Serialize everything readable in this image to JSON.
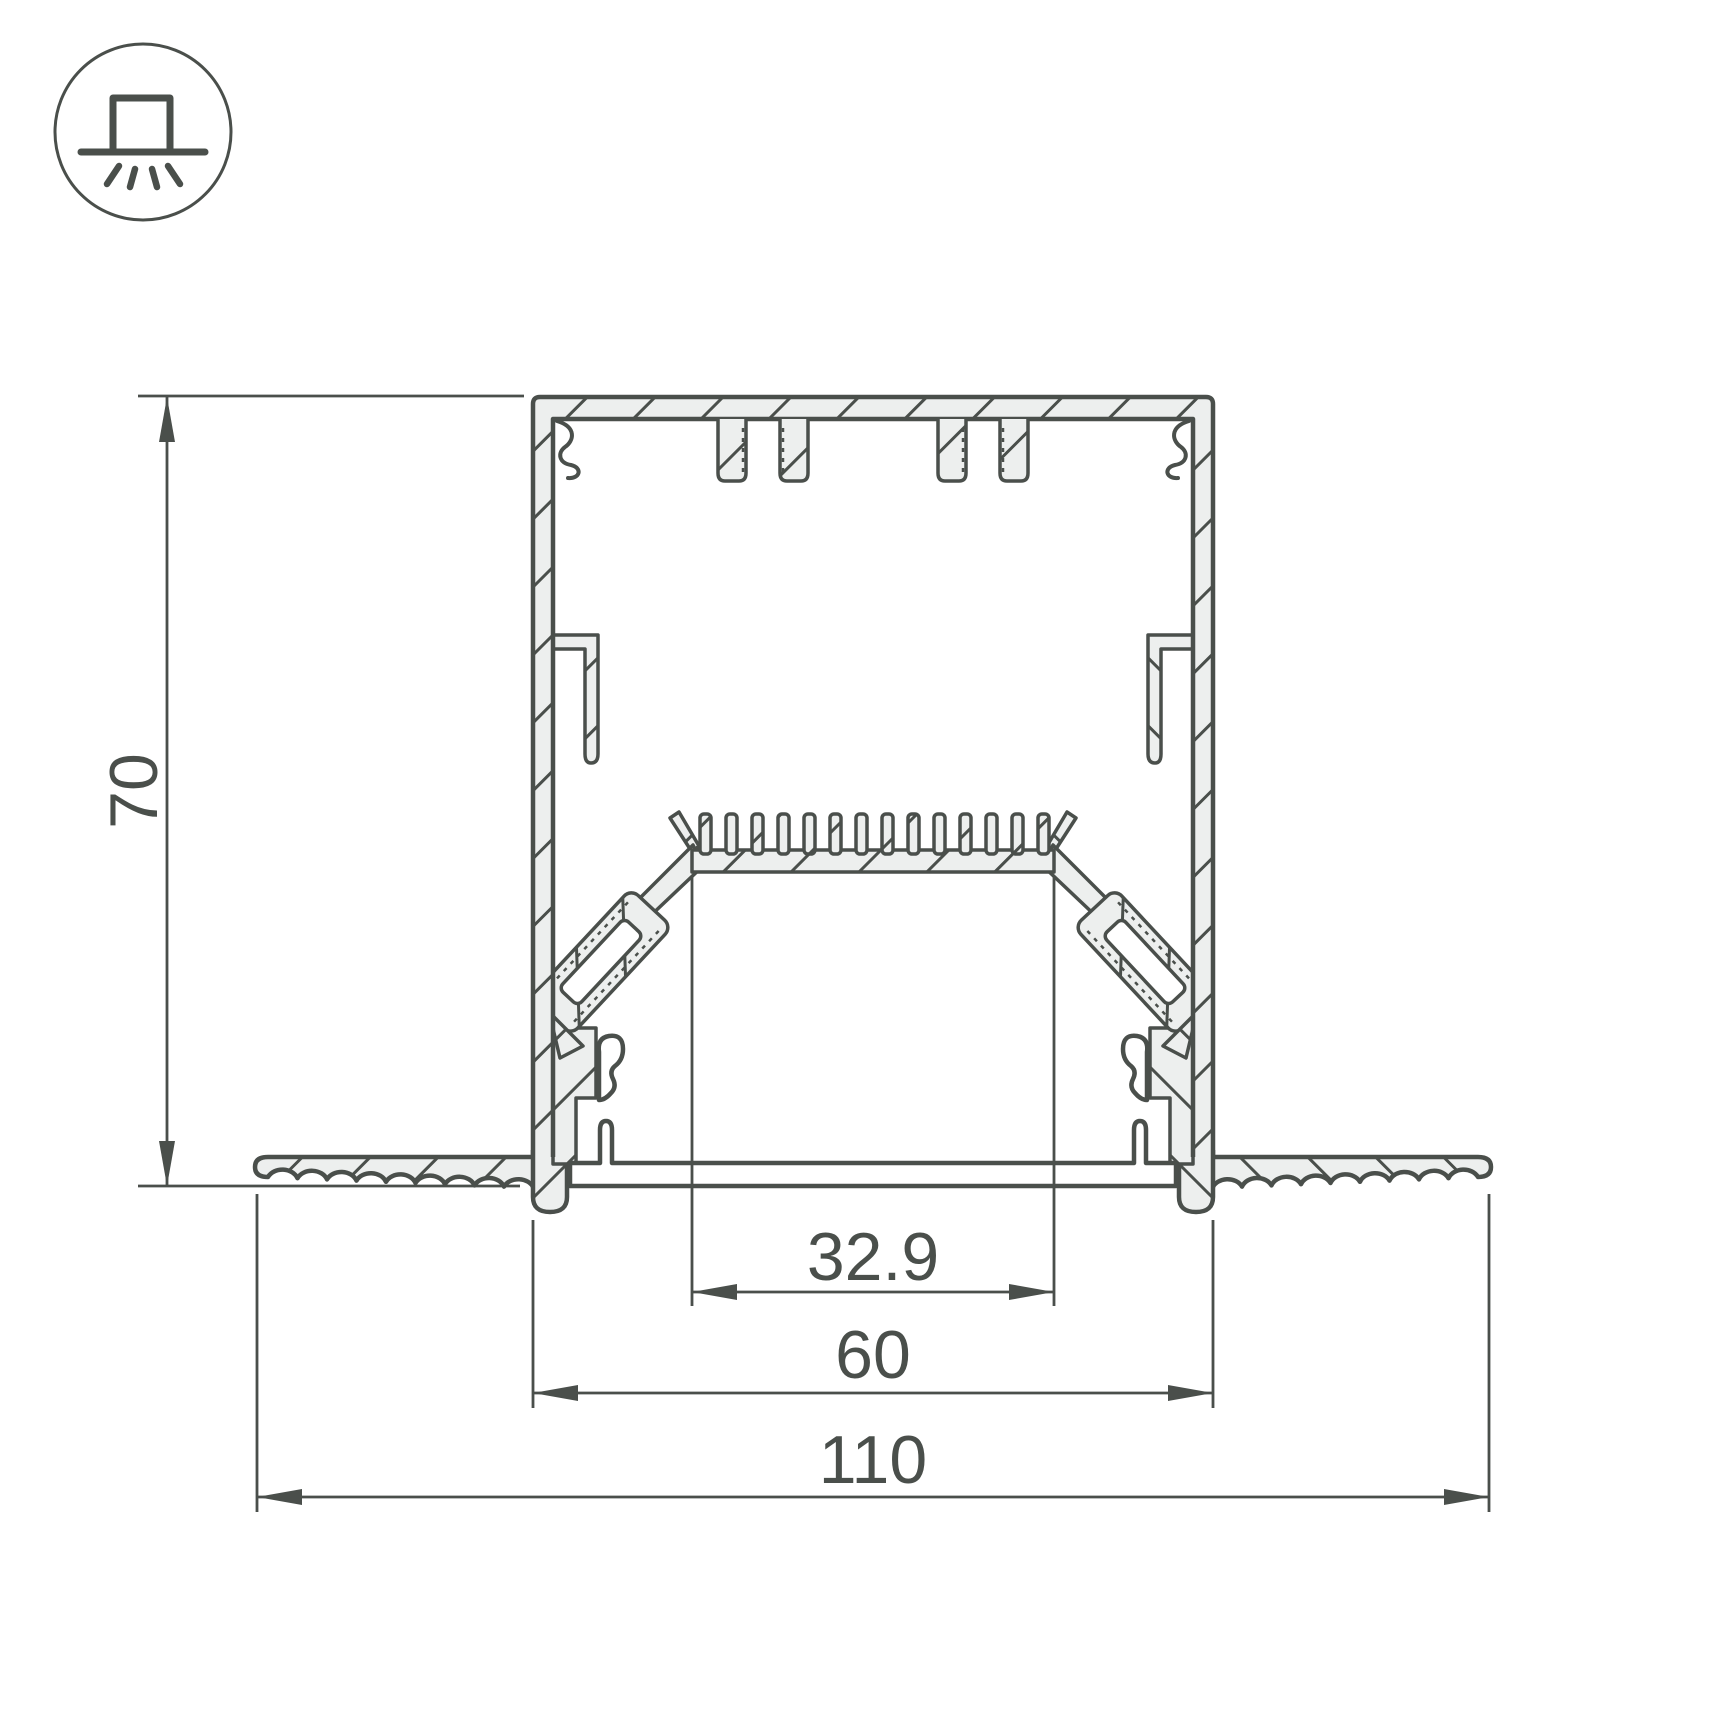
{
  "drawing": {
    "title": "recessed-led-profile-cross-section",
    "dims": {
      "height": "70",
      "opening": "32.9",
      "body": "60",
      "overall": "110"
    },
    "icon": {
      "name": "recessed-mount-icon"
    },
    "colors": {
      "line": "#4a4f4b",
      "metal_fill": "#edefee",
      "background": "#ffffff"
    }
  }
}
